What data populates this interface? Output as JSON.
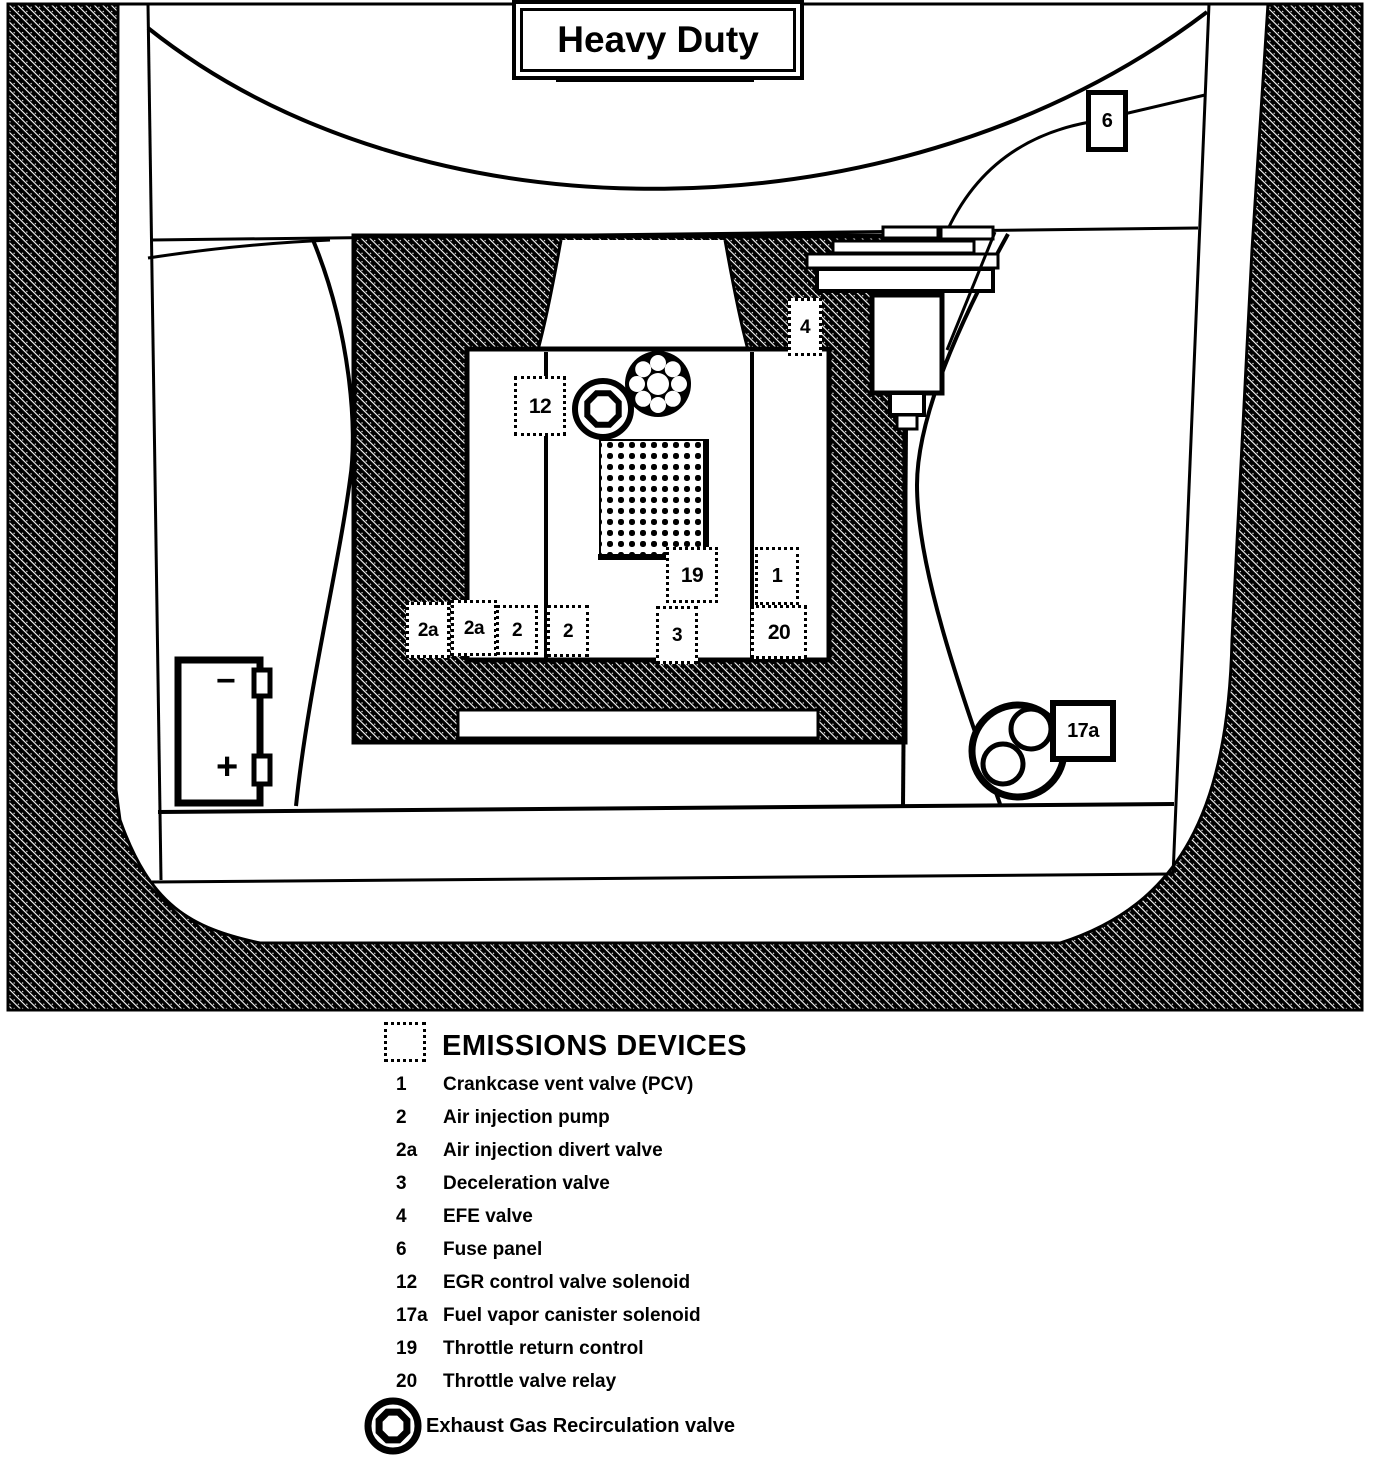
{
  "window": {
    "title": "Heavy Duty"
  },
  "diagram": {
    "callouts": {
      "fuse_panel": "6",
      "efe_valve": "4",
      "egr_solenoid": "12",
      "throttle_return": "19",
      "pcv": "1",
      "throttle_relay": "20",
      "air_divert_left": "2a",
      "air_divert_right": "2a",
      "air_pump_left": "2",
      "air_pump_right": "2",
      "decel_valve": "3",
      "vapor_canister": "17a"
    },
    "battery": {
      "negative_terminal": "−",
      "positive_terminal": "+"
    }
  },
  "legend": {
    "header": "EMISSIONS DEVICES",
    "items": [
      {
        "num": "1",
        "label": "Crankcase vent valve (PCV)"
      },
      {
        "num": "2",
        "label": "Air injection pump"
      },
      {
        "num": "2a",
        "label": "Air injection divert valve"
      },
      {
        "num": "3",
        "label": "Deceleration valve"
      },
      {
        "num": "4",
        "label": "EFE  valve"
      },
      {
        "num": "6",
        "label": "Fuse panel"
      },
      {
        "num": "12",
        "label": "EGR  control valve solenoid"
      },
      {
        "num": "17a",
        "label": "Fuel vapor canister solenoid"
      },
      {
        "num": "19",
        "label": "Throttle return control"
      },
      {
        "num": "20",
        "label": "Throttle valve relay"
      }
    ],
    "egr_item_label": "Exhaust Gas Recirculation valve"
  },
  "colors": {
    "ink": "#000000",
    "paper": "#ffffff"
  }
}
